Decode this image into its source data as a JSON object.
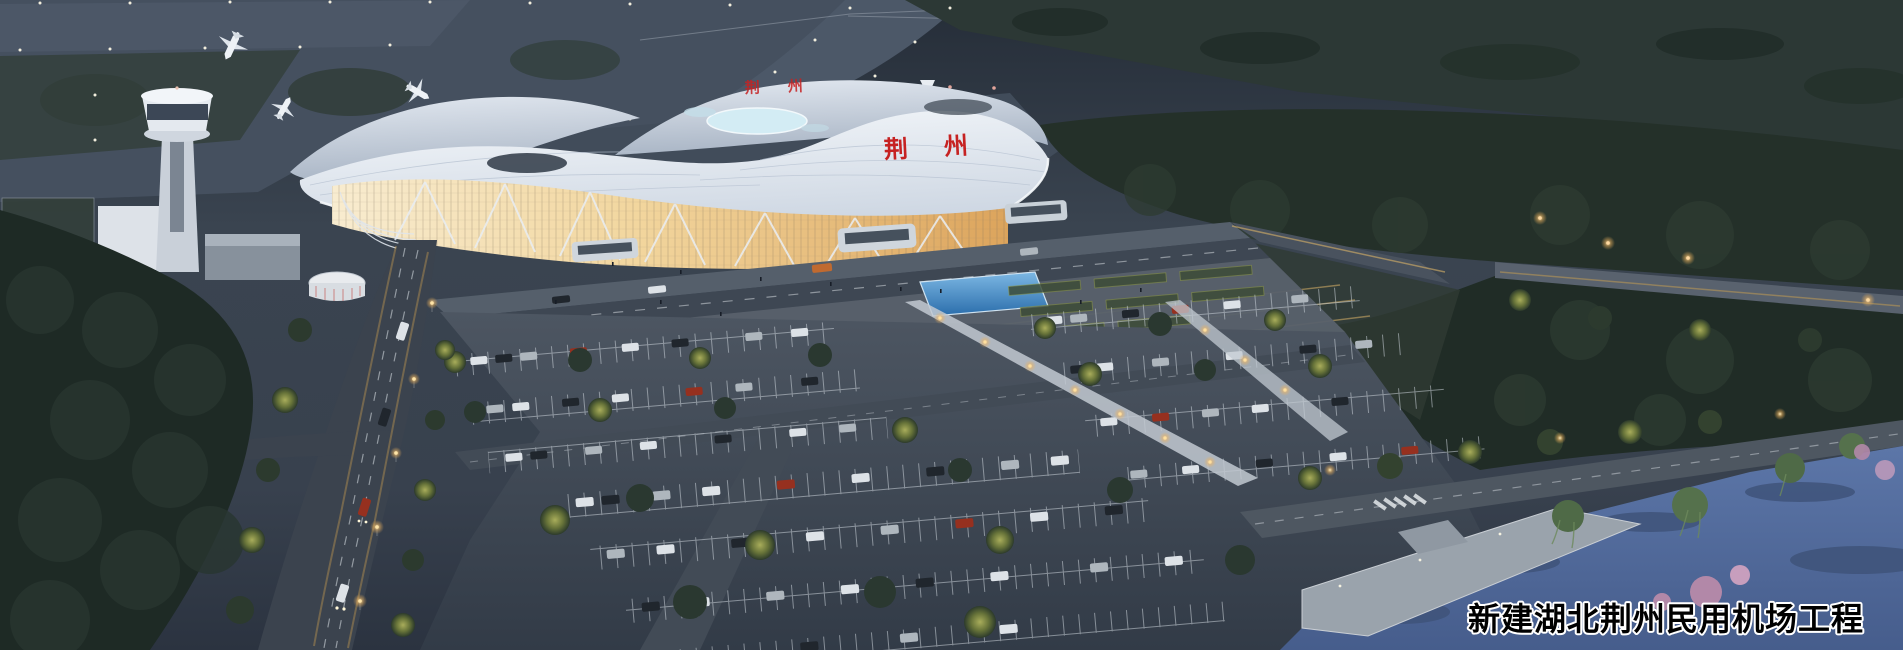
{
  "scene": {
    "type": "architectural-rendering",
    "subject": "Aerial dusk rendering of a new civil airport: wave-roofed terminal with glowing amber glass facade, control tower, taxiways with aircraft, landscaped parking lots, access roads and a lakeside park",
    "caption": "新建湖北荆州民用机场工程",
    "terminal_facade_sign": "荆州",
    "terminal_roof_sign": "荆州",
    "colors": {
      "dusk_ground": "#3a4450",
      "taxiway": "#4a5666",
      "apron": "#414c5a",
      "grass_dark": "#2c3835",
      "trees_dark": "#223029",
      "tree_lit": "#a9ad5b",
      "roof_white": "#f5f8fb",
      "roof_shadow": "#c8d2df",
      "glass_glow_light": "#f8ecd0",
      "glass_glow_amber": "#dca45c",
      "sign_red": "#c62222",
      "pool_blue": "#2a6dab",
      "water_blue": "#5c76a8",
      "road_asphalt": "#3e4753",
      "lamp_warm": "#edb35f",
      "blossom_pink": "#b288a8",
      "willow_green": "#4f6a47",
      "caption_fill": "#000000",
      "caption_stroke": "#ffffff"
    }
  }
}
